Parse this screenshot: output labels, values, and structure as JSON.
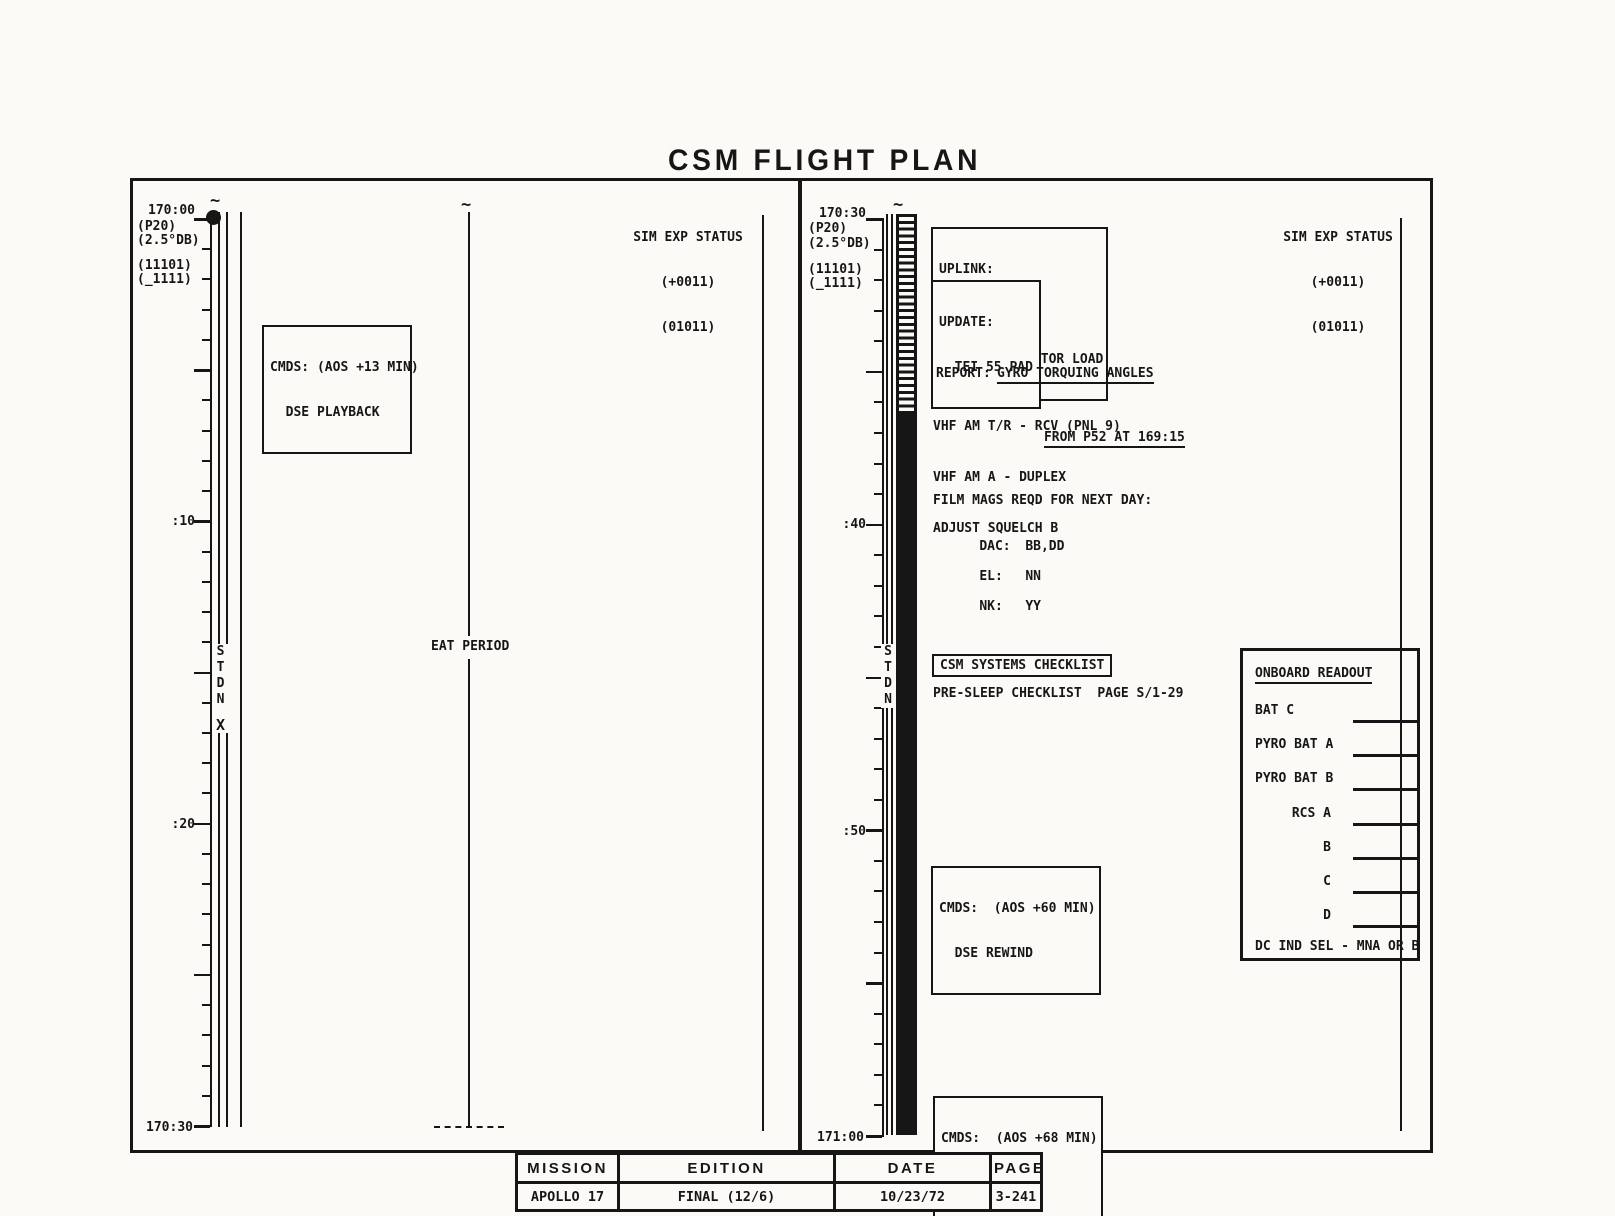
{
  "title": "CSM FLIGHT PLAN",
  "left_panel": {
    "time_top": "170:00",
    "time_bottom": "170:30",
    "config_labels": {
      "l1": "(P20)",
      "l2": "(2.5°DB)",
      "l3": "(11101)",
      "l4": "(_1111)"
    },
    "tick_10": ":10",
    "tick_20": ":20",
    "stdn_track": {
      "s": "S",
      "t": "T",
      "d": "D",
      "n": "N",
      "x": "X"
    },
    "cmds_box": {
      "line1": "CMDS: (AOS +13 MIN)",
      "line2": "  DSE PLAYBACK"
    },
    "eat_period_label": "EAT PERIOD",
    "sim_exp_status": {
      "line1": "SIM EXP STATUS",
      "line2": "(+0011)",
      "line3": "(01011)"
    }
  },
  "right_panel": {
    "time_top": "170:30",
    "time_bottom": "171:00",
    "config_labels": {
      "l1": "(P20)",
      "l2": "(2.5°DB)",
      "l3": "(11101)",
      "l4": "(_1111)"
    },
    "tick_40": ":40",
    "tick_50": ":50",
    "stdn_track": {
      "s": "S",
      "t": "T",
      "d": "D",
      "n": "N"
    },
    "uplink_box": {
      "line1": "UPLINK:",
      "line2": "  CSM S.V.",
      "line3": "  JET-ON MONITOR LOAD"
    },
    "update_box": {
      "line1": "UPDATE:",
      "line2": "  TEI 55 PAD"
    },
    "report": {
      "label": "REPORT:",
      "line1": "GYRO TORQUING ANGLES",
      "line2": "FROM P52 AT 169:15"
    },
    "comm_lines": {
      "line1": "VHF AM T/R - RCV (PNL 9)",
      "line2": "VHF AM A - DUPLEX",
      "line3": "ADJUST SQUELCH B"
    },
    "film_mags": {
      "header": "FILM MAGS REQD FOR NEXT DAY:",
      "dac_label": "DAC:",
      "dac_value": "BB,DD",
      "el_label": "EL:",
      "el_value": "NN",
      "nk_label": "NK:",
      "nk_value": "YY"
    },
    "checklist": {
      "box_label": "CSM SYSTEMS CHECKLIST",
      "line": "PRE-SLEEP CHECKLIST  PAGE S/1-29"
    },
    "cmds_rewind_box": {
      "line1": "CMDS:  (AOS +60 MIN)",
      "line2": "  DSE REWIND"
    },
    "cmds_record_box": {
      "line1": "CMDS:  (AOS +68 MIN)",
      "line2": "  DSE RECORD"
    },
    "onboard_readout": {
      "title": "ONBOARD READOUT",
      "row1": "BAT C",
      "row2": "PYRO BAT A",
      "row3": "PYRO BAT B",
      "row4": "RCS A",
      "row5": "B",
      "row6": "C",
      "row7": "D",
      "footer": "DC IND SEL - MNA OR B"
    },
    "sim_exp_status": {
      "line1": "SIM EXP STATUS",
      "line2": "(+0011)",
      "line3": "(01011)"
    }
  },
  "footer_table": {
    "headers": {
      "mission": "MISSION",
      "edition": "EDITION",
      "date": "DATE",
      "page": "PAGE"
    },
    "values": {
      "mission": "APOLLO 17",
      "edition": "FINAL (12/6)",
      "date": "10/23/72",
      "page": "3-241"
    }
  }
}
